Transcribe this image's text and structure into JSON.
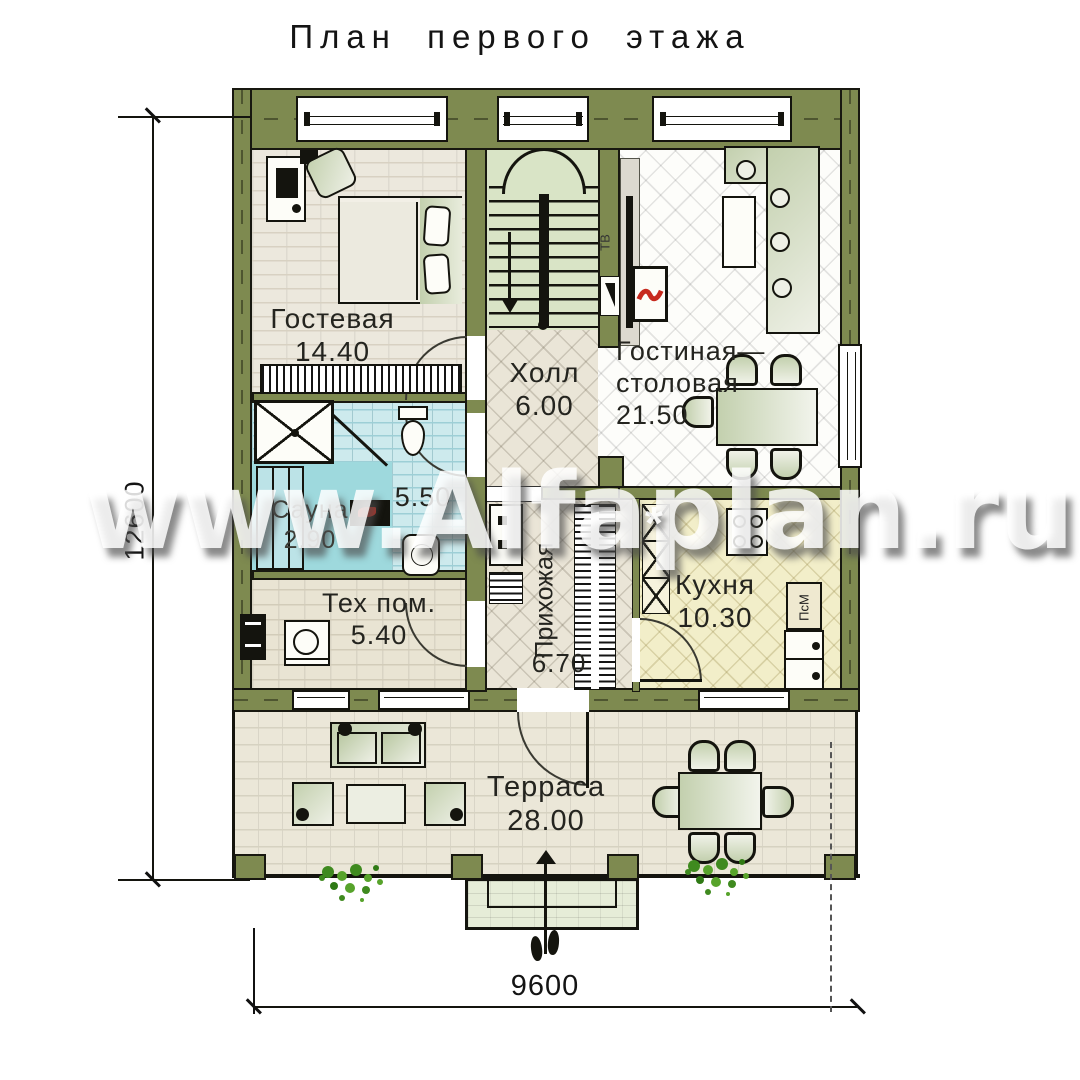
{
  "title": "План первого этажа",
  "watermark": {
    "text": "www.Alfaplan.ru",
    "asterisk": "*"
  },
  "dimensions": {
    "height_mm": "12600",
    "width_mm": "9600"
  },
  "rooms": {
    "guest": {
      "name": "Гостевая",
      "area": "14.40"
    },
    "hall": {
      "name": "Холл",
      "area": "6.00"
    },
    "living": {
      "line1": "Гостиная—",
      "line2": "столовая",
      "area": "21.50"
    },
    "bath": {
      "area": "5.50"
    },
    "sauna": {
      "name": "Сауна",
      "area": "2.90"
    },
    "tech": {
      "name": "Тех пом.",
      "area": "5.40"
    },
    "entry": {
      "name": "Прихожая",
      "area": "6.70"
    },
    "kitchen": {
      "name": "Кухня",
      "area": "10.30"
    },
    "terrace": {
      "name": "Терраса",
      "area": "28.00"
    }
  },
  "appliances": {
    "dishwasher": "ПсМ",
    "tv": "ТВ"
  },
  "colors": {
    "wall": "#7e8a50",
    "sauna": "#9ed9dd",
    "bath": "#cdeaed",
    "kitchen": "#f2eec9",
    "stairs": "#d9e4c6",
    "flame": "#c72a1e"
  }
}
